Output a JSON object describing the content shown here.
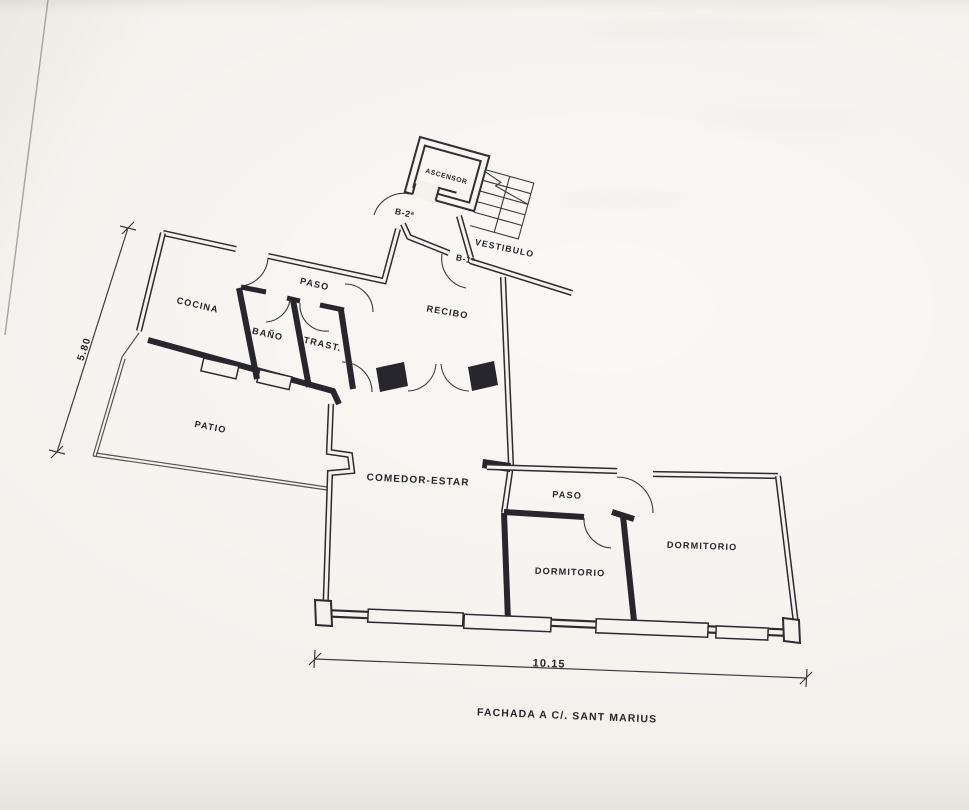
{
  "plan": {
    "core": {
      "elevator_label": "ASCENSOR",
      "lobby_label": "VESTIBULO"
    },
    "doors": {
      "left_unit": "B-2ª",
      "right_unit": "B-1ª"
    },
    "rooms": {
      "kitchen": "COCINA",
      "hall_top": "PASO",
      "bath": "BAÑO",
      "storage": "TRAST.",
      "entry_hall": "RECIBO",
      "patio": "PATIO",
      "living": "COMEDOR-ESTAR",
      "hall_right": "PASO",
      "bedroom_left": "DORMITORIO",
      "bedroom_right": "DORMITORIO"
    },
    "dimensions": {
      "left": "5.80",
      "bottom": "10.15"
    },
    "caption": "FACHADA A C/. SANT MARIUS"
  }
}
